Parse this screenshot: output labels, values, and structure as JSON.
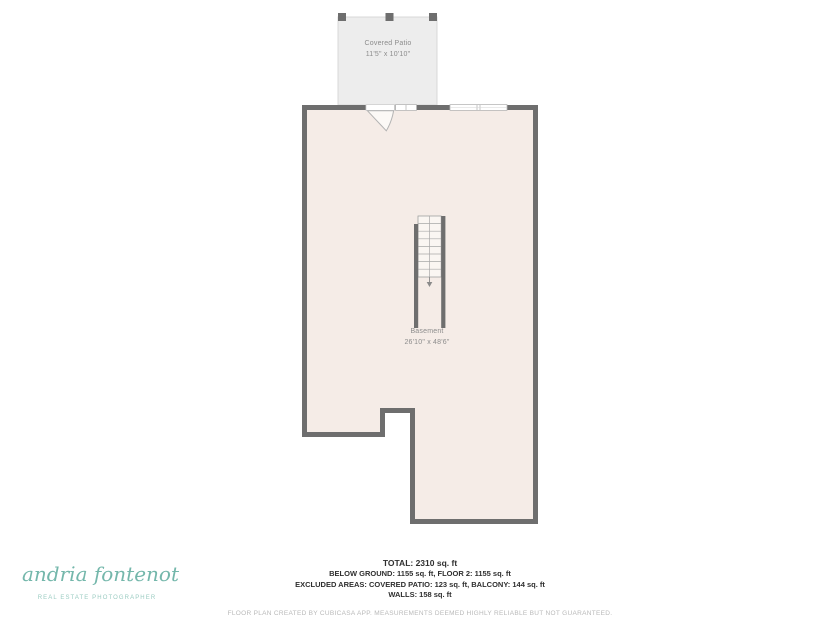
{
  "floorplan": {
    "rooms": {
      "covered_patio": {
        "name": "Covered Patio",
        "dimensions": "11'5\" x 10'10\""
      },
      "basement": {
        "name": "Basement",
        "dimensions": "26'10\" x 48'6\""
      }
    },
    "colors": {
      "wall": "#6e6e6e",
      "floor_fill": "#f5ece7",
      "patio_fill": "#ededed",
      "room_label": "#8c8c8c"
    }
  },
  "summary": {
    "total": "TOTAL: 2310 sq. ft",
    "lines": [
      "BELOW GROUND: 1155 sq. ft, FLOOR 2: 1155 sq. ft",
      "EXCLUDED AREAS: COVERED PATIO: 123 sq. ft, BALCONY: 144 sq. ft",
      "WALLS: 158 sq. ft"
    ]
  },
  "branding": {
    "name": "andria fontenot",
    "tagline": "REAL ESTATE PHOTOGRAPHER",
    "accent_color": "#74b7ab"
  },
  "footer": {
    "disclaimer": "FLOOR PLAN CREATED BY CUBICASA APP. MEASUREMENTS DEEMED HIGHLY RELIABLE BUT NOT GUARANTEED."
  }
}
